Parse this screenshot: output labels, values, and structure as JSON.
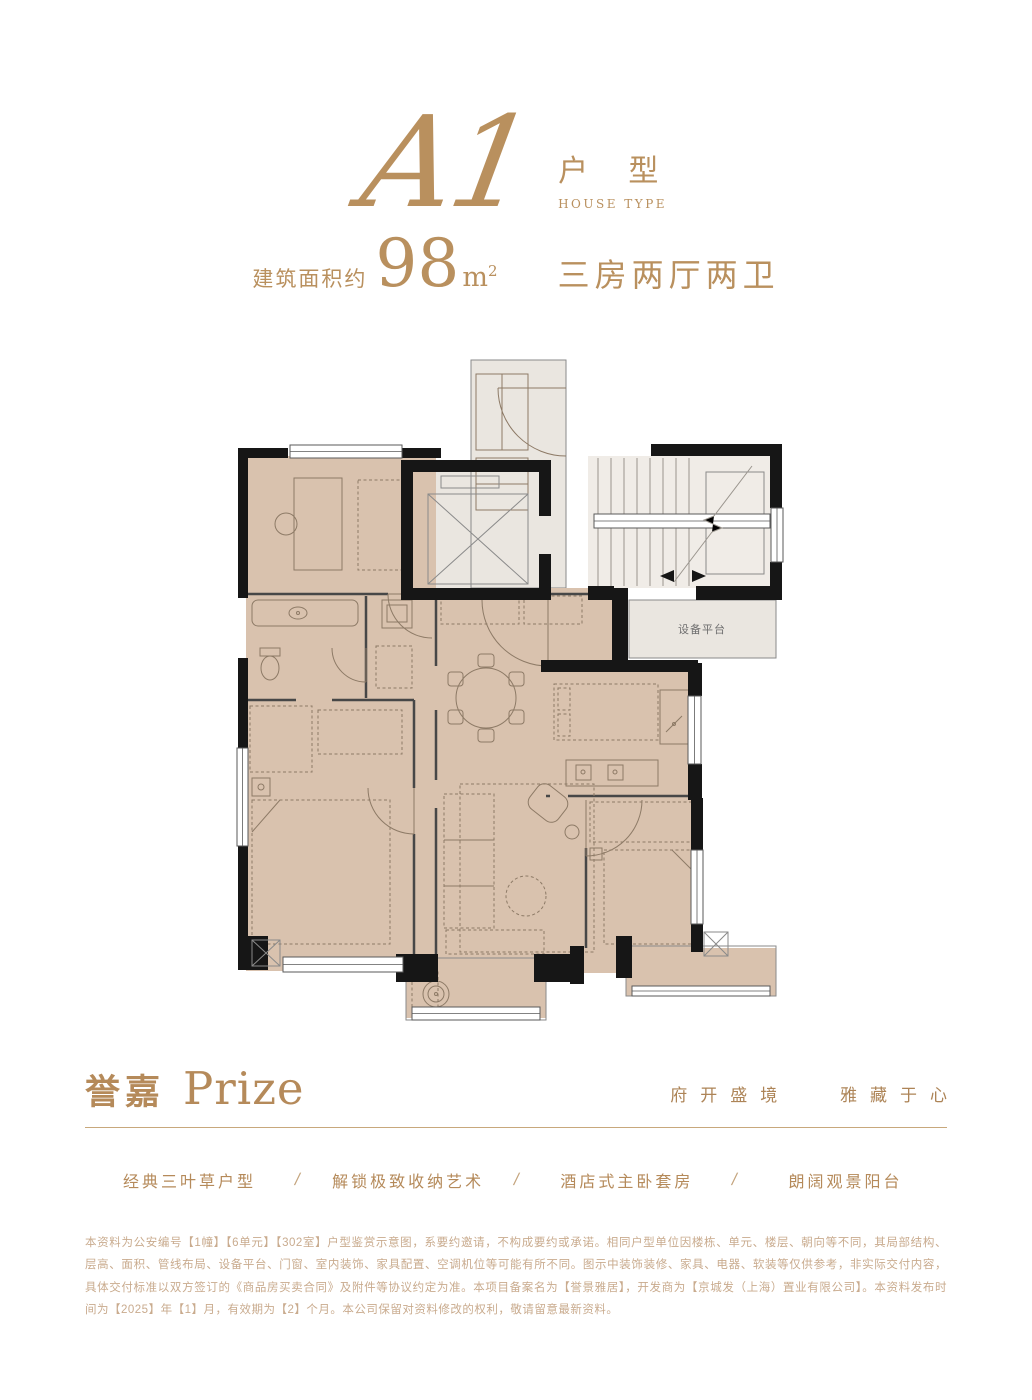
{
  "header": {
    "type_code": "A1",
    "type_label_cn": "户 型",
    "type_label_en": "HOUSE TYPE",
    "area_prefix": "建筑面积约",
    "area_value": "98",
    "area_unit": "m",
    "area_unit_sup": "2",
    "layout_desc": "三房两厅两卫"
  },
  "floor_plan": {
    "equipment_platform_label": "设备平台"
  },
  "brand": {
    "name_cn": "誉嘉",
    "name_en": "Prize",
    "tagline_left": "府开盛境",
    "tagline_right": "雅藏于心"
  },
  "features": [
    {
      "label": "经典三叶草户型"
    },
    {
      "label": "解锁极致收纳艺术"
    },
    {
      "label": "酒店式主卧套房"
    },
    {
      "label": "朗阔观景阳台"
    }
  ],
  "features_separator": "/",
  "disclaimer": "本资料为公安编号【1幢】【6单元】【302室】户型鉴赏示意图，系要约邀请，不构成要约或承诺。相同户型单位因楼栋、单元、楼层、朝向等不同，其局部结构、层高、面积、管线布局、设备平台、门窗、室内装饰、家具配置、空调机位等可能有所不同。图示中装饰装修、家具、电器、软装等仅供参考，非实际交付内容，具体交付标准以双方签订的《商品房买卖合同》及附件等协议约定为准。本项目备案名为【誉景雅居】，开发商为【京城发（上海）置业有限公司】。本资料发布时间为【2025】年【1】月，有效期为【2】个月。本公司保留对资料修改的权利，敬请留意最新资料。",
  "colors": {
    "gold": "#b58a5a",
    "gold_light": "#c9ab8e",
    "room_tan": "#d9c2ae",
    "public_gray": "#eae6e0",
    "wall": "#161616"
  }
}
